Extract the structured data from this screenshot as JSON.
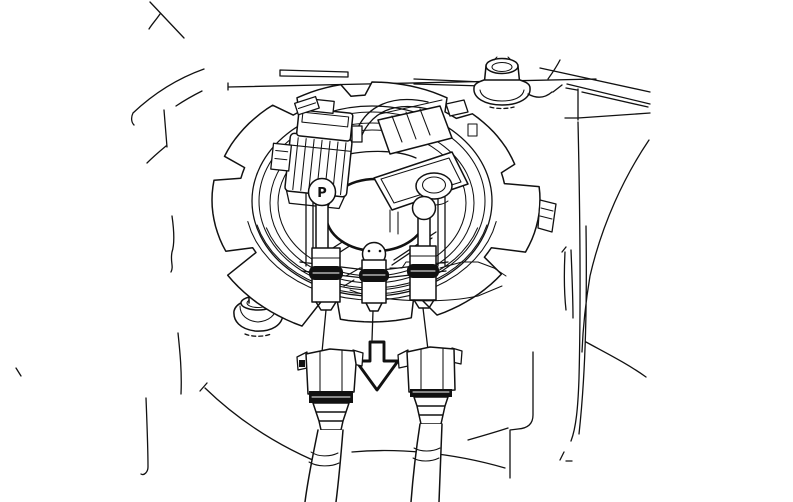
{
  "canvas": {
    "background_color": "#ffffff",
    "line_color": "#111111"
  },
  "module": {
    "port_marking": "P"
  },
  "icons": {
    "installation_arrow": "down-arrow-outline"
  }
}
